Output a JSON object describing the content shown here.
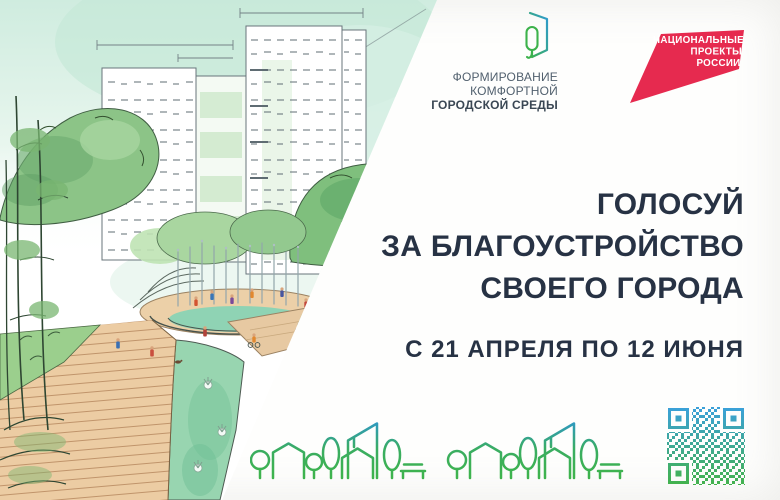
{
  "logos": {
    "fkgs": {
      "icon": "leaf-window-icon",
      "line1": "ФОРМИРОВАНИЕ",
      "line2": "КОМФОРТНОЙ",
      "line3": "ГОРОДСКОЙ СРЕДЫ"
    },
    "national_projects": {
      "shape": "red-flag-shape",
      "color": "#e62a4f",
      "line1": "НАЦИОНАЛЬНЫЕ",
      "line2": "ПРОЕКТЫ",
      "line3": "РОССИИ"
    }
  },
  "headline": {
    "color": "#273244",
    "line1": "ГОЛОСУЙ",
    "line2": "ЗА БЛАГОУСТРОЙСТВО",
    "line3": "СВОЕГО ГОРОДА"
  },
  "dates": {
    "text": "С 21 АПРЕЛЯ ПО 12 ИЮНЯ"
  },
  "footer": {
    "skyline": {
      "unit_icons": [
        "tree-icon",
        "house-icon",
        "tree-icon",
        "tree-icon",
        "buildings-icon",
        "tree-icon",
        "bench-icon"
      ],
      "repeat": 2,
      "green": "#3fb44a",
      "blue": "#2e97d1"
    },
    "qr": {
      "icon": "qr-code",
      "top_color": "#3aa0dc",
      "bottom_color": "#43b24a"
    }
  },
  "illustration": {
    "subject": "watercolor sketch of a park: fountains, boardwalk, trees, apartment buildings"
  }
}
